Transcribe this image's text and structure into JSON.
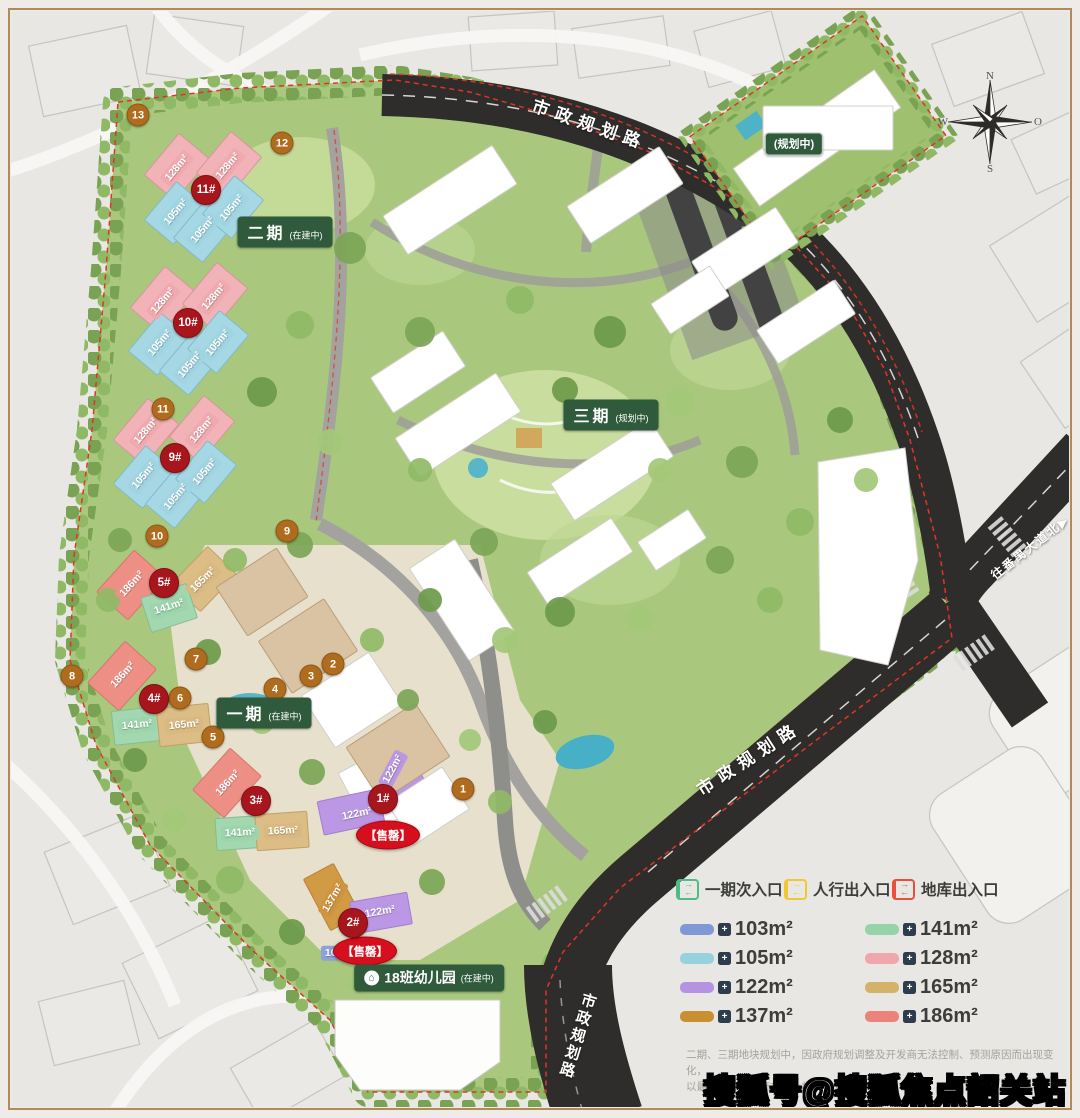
{
  "map": {
    "phase_labels": [
      {
        "main": "二期",
        "sub": "(在建中)",
        "x": 285,
        "y": 232
      },
      {
        "main": "三期",
        "sub": "(规划中)",
        "x": 611,
        "y": 415
      },
      {
        "main": "一期",
        "sub": "(在建中)",
        "x": 264,
        "y": 713
      },
      {
        "main": "",
        "sub": "(规划中)",
        "x": 794,
        "y": 144
      }
    ],
    "building_markers": [
      {
        "label": "11#",
        "x": 206,
        "y": 190
      },
      {
        "label": "10#",
        "x": 188,
        "y": 323
      },
      {
        "label": "9#",
        "x": 175,
        "y": 458
      },
      {
        "label": "5#",
        "x": 164,
        "y": 583
      },
      {
        "label": "4#",
        "x": 154,
        "y": 699
      },
      {
        "label": "3#",
        "x": 256,
        "y": 801
      },
      {
        "label": "1#",
        "x": 383,
        "y": 799
      },
      {
        "label": "2#",
        "x": 353,
        "y": 923
      }
    ],
    "site_markers": [
      {
        "label": "13",
        "x": 138,
        "y": 115
      },
      {
        "label": "12",
        "x": 282,
        "y": 143
      },
      {
        "label": "11",
        "x": 163,
        "y": 409
      },
      {
        "label": "10",
        "x": 157,
        "y": 536
      },
      {
        "label": "9",
        "x": 287,
        "y": 531
      },
      {
        "label": "8",
        "x": 72,
        "y": 676
      },
      {
        "label": "7",
        "x": 196,
        "y": 659
      },
      {
        "label": "6",
        "x": 180,
        "y": 698
      },
      {
        "label": "5",
        "x": 213,
        "y": 737
      },
      {
        "label": "4",
        "x": 275,
        "y": 689
      },
      {
        "label": "3",
        "x": 311,
        "y": 676
      },
      {
        "label": "2",
        "x": 333,
        "y": 664
      },
      {
        "label": "1",
        "x": 463,
        "y": 789
      }
    ],
    "unit_tags": [
      {
        "label": "128m²",
        "x": 177,
        "y": 168,
        "rot": -50,
        "color": "#f0a9ae"
      },
      {
        "label": "128m²",
        "x": 228,
        "y": 166,
        "rot": -50,
        "color": "#f0a9ae"
      },
      {
        "label": "105m²",
        "x": 176,
        "y": 212,
        "rot": -50,
        "color": "#9fd4e0"
      },
      {
        "label": "105m²",
        "x": 203,
        "y": 230,
        "rot": -50,
        "color": "#9fd4e0"
      },
      {
        "label": "105m²",
        "x": 232,
        "y": 208,
        "rot": -50,
        "color": "#9fd4e0"
      },
      {
        "label": "128m²",
        "x": 163,
        "y": 301,
        "rot": -50,
        "color": "#f0a9ae"
      },
      {
        "label": "128m²",
        "x": 214,
        "y": 297,
        "rot": -50,
        "color": "#f0a9ae"
      },
      {
        "label": "105m²",
        "x": 160,
        "y": 343,
        "rot": -50,
        "color": "#9fd4e0"
      },
      {
        "label": "105m²",
        "x": 190,
        "y": 365,
        "rot": -50,
        "color": "#9fd4e0"
      },
      {
        "label": "105m²",
        "x": 218,
        "y": 343,
        "rot": -50,
        "color": "#9fd4e0"
      },
      {
        "label": "128m²",
        "x": 146,
        "y": 431,
        "rot": -50,
        "color": "#f0a9ae"
      },
      {
        "label": "128m²",
        "x": 202,
        "y": 430,
        "rot": -50,
        "color": "#f0a9ae"
      },
      {
        "label": "105m²",
        "x": 144,
        "y": 476,
        "rot": -50,
        "color": "#9fd4e0"
      },
      {
        "label": "105m²",
        "x": 205,
        "y": 472,
        "rot": -50,
        "color": "#9fd4e0"
      },
      {
        "label": "105m²",
        "x": 176,
        "y": 497,
        "rot": -50,
        "color": "#9fd4e0"
      },
      {
        "label": "186m²",
        "x": 132,
        "y": 584,
        "rot": -48,
        "color": "#ee9086"
      },
      {
        "label": "165m²",
        "x": 203,
        "y": 580,
        "rot": -45,
        "color": "#d9b97f"
      },
      {
        "label": "141m²",
        "x": 169,
        "y": 607,
        "rot": -18,
        "color": "#9cd4ac"
      },
      {
        "label": "186m²",
        "x": 123,
        "y": 675,
        "rot": -48,
        "color": "#ee9086"
      },
      {
        "label": "141m²",
        "x": 137,
        "y": 725,
        "rot": -5,
        "color": "#9cd4ac"
      },
      {
        "label": "165m²",
        "x": 184,
        "y": 725,
        "rot": -5,
        "color": "#d9b97f"
      },
      {
        "label": "186m²",
        "x": 228,
        "y": 783,
        "rot": -48,
        "color": "#ee9086"
      },
      {
        "label": "141m²",
        "x": 240,
        "y": 833,
        "rot": -3,
        "color": "#9cd4ac"
      },
      {
        "label": "165m²",
        "x": 283,
        "y": 831,
        "rot": -3,
        "color": "#d9b97f"
      },
      {
        "label": "122m²",
        "x": 393,
        "y": 769,
        "rot": -62,
        "color": "#ba97e2"
      },
      {
        "label": "122m²",
        "x": 357,
        "y": 814,
        "rot": -12,
        "color": "#ba97e2"
      },
      {
        "label": "137m²",
        "x": 333,
        "y": 898,
        "rot": -60,
        "color": "#cf9440"
      },
      {
        "label": "122m²",
        "x": 380,
        "y": 912,
        "rot": -10,
        "color": "#ba97e2"
      },
      {
        "label": "103m²",
        "x": 340,
        "y": 953,
        "rot": 0,
        "color": "#8ba3d8"
      }
    ],
    "sold_out_labels": [
      {
        "label": "【售罄】",
        "x": 388,
        "y": 835
      },
      {
        "label": "【售罄】",
        "x": 365,
        "y": 951
      }
    ],
    "kindergarten_label": {
      "icon": "⌂",
      "main": "18班幼儿园",
      "sub": "(在建中)",
      "x": 429,
      "y": 978
    },
    "road_labels": [
      {
        "label": "市政规划路",
        "x": 590,
        "y": 123,
        "rot": 19,
        "size": 17,
        "spacing": 7,
        "vertical": false
      },
      {
        "label": "市政规划路",
        "x": 748,
        "y": 757,
        "rot": -33,
        "size": 17,
        "spacing": 7,
        "vertical": false
      },
      {
        "label": "市政规划路",
        "x": 577,
        "y": 1036,
        "rot": 17,
        "size": 15,
        "spacing": 3,
        "vertical": true
      },
      {
        "label": "往番禺大道北▶",
        "x": 1030,
        "y": 547,
        "rot": -38,
        "size": 12,
        "spacing": 2,
        "vertical": false
      }
    ],
    "compass": {
      "n": "N",
      "e": "O",
      "s": "S",
      "w": "W",
      "x": 990,
      "y": 122
    }
  },
  "legend": {
    "entrances": [
      {
        "label": "一期次入口",
        "color": "#4dbd85"
      },
      {
        "label": "人行出入口",
        "color": "#f2c832"
      },
      {
        "label": "地库出入口",
        "color": "#e8503a"
      }
    ],
    "unit_areas": [
      {
        "label": "103m²",
        "color": "#8099d6",
        "col": 0,
        "row": 0
      },
      {
        "label": "105m²",
        "color": "#96d2de",
        "col": 0,
        "row": 1
      },
      {
        "label": "122m²",
        "color": "#b493e2",
        "col": 0,
        "row": 2
      },
      {
        "label": "137m²",
        "color": "#ca8f33",
        "col": 0,
        "row": 3
      },
      {
        "label": "141m²",
        "color": "#96d3a8",
        "col": 1,
        "row": 0
      },
      {
        "label": "128m²",
        "color": "#f0a7ab",
        "col": 1,
        "row": 1
      },
      {
        "label": "165m²",
        "color": "#d4b269",
        "col": 1,
        "row": 2
      },
      {
        "label": "186m²",
        "color": "#ec837a",
        "col": 1,
        "row": 3
      }
    ],
    "floorplan_icon_glyph": "+",
    "entrance_arrows": [
      "→",
      "←"
    ]
  },
  "disclaimer": {
    "line1": "二期、三期地块规划中，因政府规划调整及开发商无法控制、预测原因而出现变化，",
    "line2": "以最新公布的政府文件及相关官方信息为准。"
  },
  "watermark": "搜狐号@搜狐焦点韶关站"
}
